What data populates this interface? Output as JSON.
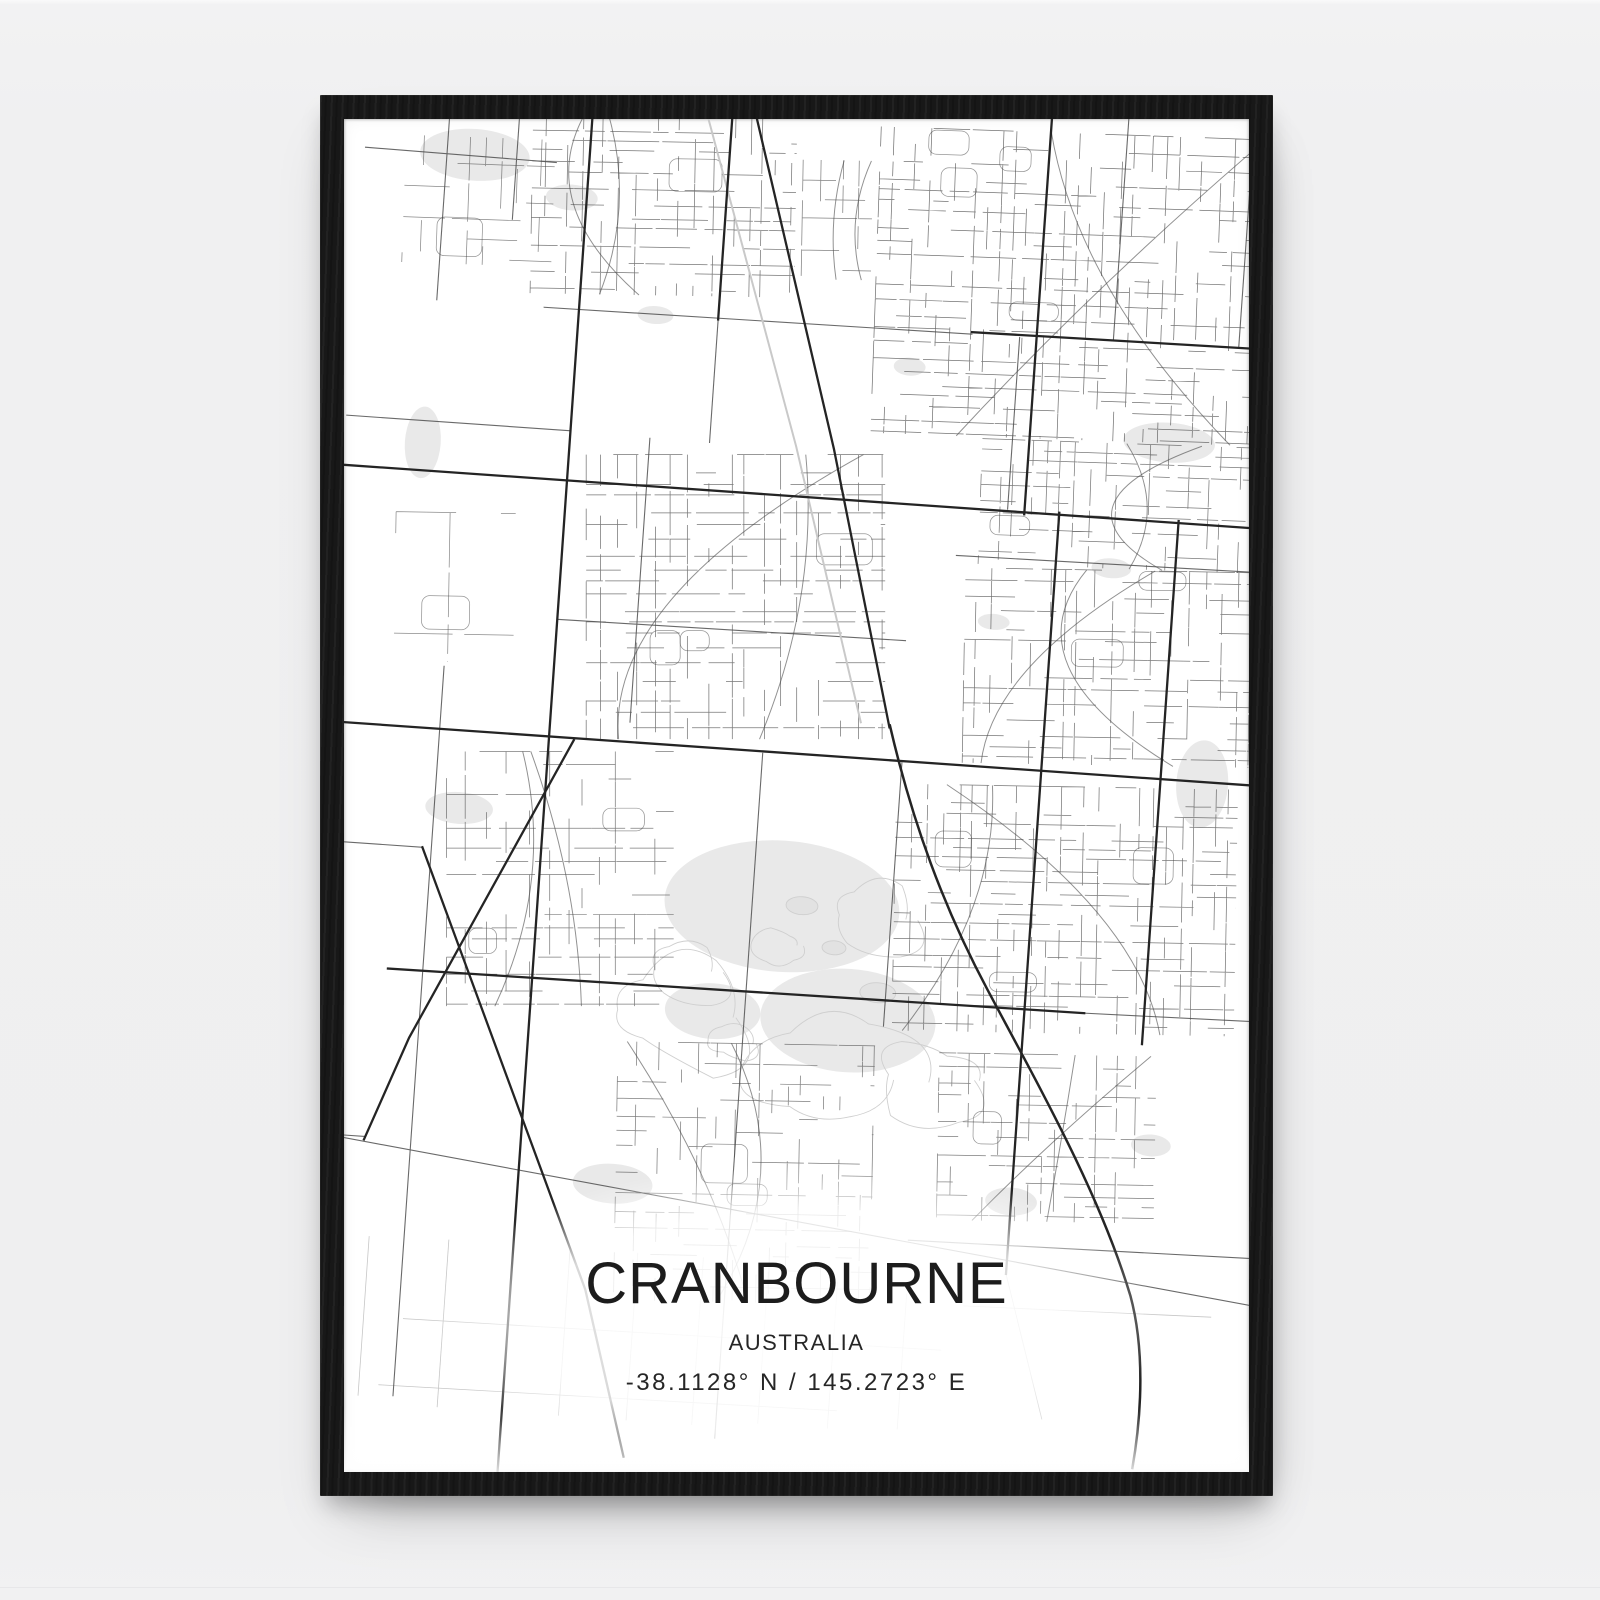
{
  "scene": {
    "background_color": "#f0f0f1"
  },
  "frame": {
    "color": "#181818"
  },
  "poster": {
    "title": "CRANBOURNE",
    "subtitle": "AUSTRALIA",
    "coordinates": "-38.1128° N / 145.2723° E",
    "paper_color": "#ffffff",
    "text_color": "#1e1e1e"
  },
  "map": {
    "rotation_deg": 4,
    "colors": {
      "major_road": "#242424",
      "medium_road": "#4f4f4f",
      "minor_road": "#3f3f3f",
      "faint_road": "#8f8f8f",
      "railway": "#c9c9c9",
      "park": "#e9e9e9",
      "pond": "#e2e2e2",
      "park_path": "#cfcfcf"
    },
    "major_roads": [
      [
        [
          205,
          -60
        ],
        [
          205,
          1420
        ]
      ],
      [
        [
          345,
          -60
        ],
        [
          345,
          208
        ]
      ],
      [
        [
          665,
          -60
        ],
        [
          665,
          382
        ]
      ],
      [
        [
          700,
          378
        ],
        [
          700,
          1145
        ]
      ],
      [
        [
          820,
          378
        ],
        [
          820,
          905
        ]
      ],
      [
        [
          -60,
          380
        ],
        [
          968,
          380
        ]
      ],
      [
        [
          -60,
          638
        ],
        [
          968,
          638
        ]
      ],
      [
        [
          600,
          203
        ],
        [
          968,
          199
        ]
      ],
      [
        [
          60,
          882
        ],
        [
          760,
          878
        ]
      ],
      [
        [
          350,
          -60
        ],
        [
          470,
          330
        ],
        [
          545,
          605
        ]
      ],
      [
        [
          230,
          640
        ],
        [
          86,
          950
        ],
        [
          48,
          1055
        ]
      ],
      [
        [
          86,
          758
        ],
        [
          280,
          1190
        ],
        [
          330,
          1355
        ]
      ]
    ],
    "medium_roads": [
      [
        [
          170,
          208
        ],
        [
          600,
          205
        ]
      ],
      [
        [
          -20,
          330
        ],
        [
          205,
          330
        ]
      ],
      [
        [
          285,
          332
        ],
        [
          285,
          618
        ]
      ],
      [
        [
          600,
          428
        ],
        [
          908,
          424
        ]
      ],
      [
        [
          205,
          520
        ],
        [
          555,
          517
        ]
      ],
      [
        [
          95,
          575
        ],
        [
          95,
          1310
        ]
      ],
      [
        [
          420,
          640
        ],
        [
          420,
          1330
        ]
      ],
      [
        [
          560,
          640
        ],
        [
          560,
          905
        ]
      ],
      [
        [
          -20,
          758
        ],
        [
          86,
          758
        ]
      ],
      [
        [
          760,
          878
        ],
        [
          968,
          874
        ]
      ],
      [
        [
          600,
          1118
        ],
        [
          968,
          1112
        ]
      ],
      [
        [
          -20,
          1052
        ],
        [
          48,
          1052
        ]
      ],
      [
        [
          -20,
          60
        ],
        [
          172,
          62
        ]
      ],
      [
        [
          62,
          -20
        ],
        [
          62,
          208
        ]
      ],
      [
        [
          132,
          -20
        ],
        [
          132,
          122
        ]
      ],
      [
        [
          742,
          -60
        ],
        [
          742,
          200
        ]
      ],
      [
        [
          868,
          -60
        ],
        [
          868,
          199
        ]
      ],
      [
        [
          345,
          208
        ],
        [
          345,
          332
        ]
      ],
      [
        [
          -30,
          1048
        ],
        [
          950,
          1160
        ]
      ],
      [
        [
          648,
          205
        ],
        [
          648,
          378
        ]
      ]
    ],
    "faint_roads": [
      [
        [
          140,
          1150
        ],
        [
          140,
          1318
        ]
      ],
      [
        [
          262,
          1150
        ],
        [
          262,
          1318
        ]
      ],
      [
        [
          330,
          1150
        ],
        [
          330,
          1318
        ]
      ],
      [
        [
          396,
          1150
        ],
        [
          396,
          1318
        ]
      ],
      [
        [
          462,
          1160
        ],
        [
          462,
          1312
        ]
      ],
      [
        [
          532,
          1165
        ],
        [
          532,
          1312
        ]
      ],
      [
        [
          602,
          1172
        ],
        [
          602,
          1308
        ]
      ],
      [
        [
          60,
          1152
        ],
        [
          60,
          1312
        ]
      ],
      [
        [
          100,
          1232
        ],
        [
          640,
          1226
        ]
      ],
      [
        [
          80,
          1300
        ],
        [
          540,
          1294
        ]
      ],
      [
        [
          700,
          1145
        ],
        [
          746,
          1288
        ]
      ],
      [
        [
          660,
          1180
        ],
        [
          908,
          1174
        ]
      ]
    ],
    "railway_light": [
      [
        298,
        -60
      ],
      [
        432,
        330
      ],
      [
        516,
        602
      ]
    ],
    "railway_curve": "M 545 602 C 575 700 612 782 662 862 C 722 958 788 1058 826 1158 C 844 1210 846 1275 840 1332",
    "parks": [
      {
        "cx": 90,
        "cy": 60,
        "rx": 55,
        "ry": 26
      },
      {
        "cx": 190,
        "cy": 96,
        "rx": 26,
        "ry": 13
      },
      {
        "cx": 805,
        "cy": 300,
        "rx": 46,
        "ry": 20
      },
      {
        "cx": 540,
        "cy": 242,
        "rx": 16,
        "ry": 9
      },
      {
        "cx": 862,
        "cy": 640,
        "rx": 26,
        "ry": 44
      },
      {
        "cx": 120,
        "cy": 716,
        "rx": 34,
        "ry": 16
      },
      {
        "cx": 450,
        "cy": 792,
        "rx": 118,
        "ry": 66
      },
      {
        "cx": 524,
        "cy": 902,
        "rx": 88,
        "ry": 52
      },
      {
        "cx": 388,
        "cy": 902,
        "rx": 48,
        "ry": 28
      },
      {
        "cx": 300,
        "cy": 1082,
        "rx": 40,
        "ry": 20
      },
      {
        "cx": 700,
        "cy": 1072,
        "rx": 26,
        "ry": 14
      },
      {
        "cx": 836,
        "cy": 1006,
        "rx": 20,
        "ry": 11
      },
      {
        "cx": 58,
        "cy": 352,
        "rx": 18,
        "ry": 36
      },
      {
        "cx": 642,
        "cy": 492,
        "rx": 16,
        "ry": 8
      },
      {
        "cx": 756,
        "cy": 430,
        "rx": 20,
        "ry": 10
      },
      {
        "cx": 282,
        "cy": 208,
        "rx": 18,
        "ry": 9
      }
    ]
  }
}
